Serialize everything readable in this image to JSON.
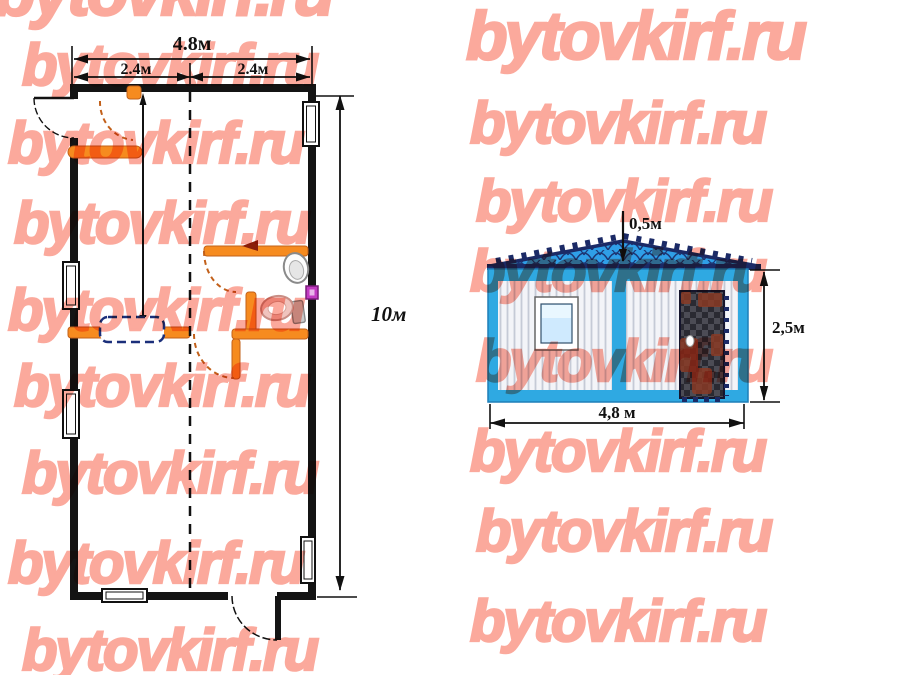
{
  "watermark": {
    "text": "bytovkirf.ru"
  },
  "colors": {
    "watermark": "#fba99c",
    "ink": "#141414",
    "orange": "#f68b1f",
    "orange-dark": "#c2601a",
    "navy-dash": "#1b2f7a",
    "cyan": "#2fa9e2",
    "roof-blue": "#2f9fe8",
    "roof-navy": "#1b2a66",
    "rust": "#8c3a24",
    "magenta": "#c23bc2"
  },
  "floor_plan": {
    "dims": {
      "width_total": "4.8м",
      "width_left": "2.4м",
      "width_right": "2.4м",
      "length": "10м"
    }
  },
  "elevation": {
    "dims": {
      "roof_height": "0,5м",
      "height": "2,5м",
      "width": "4,8 м"
    }
  }
}
